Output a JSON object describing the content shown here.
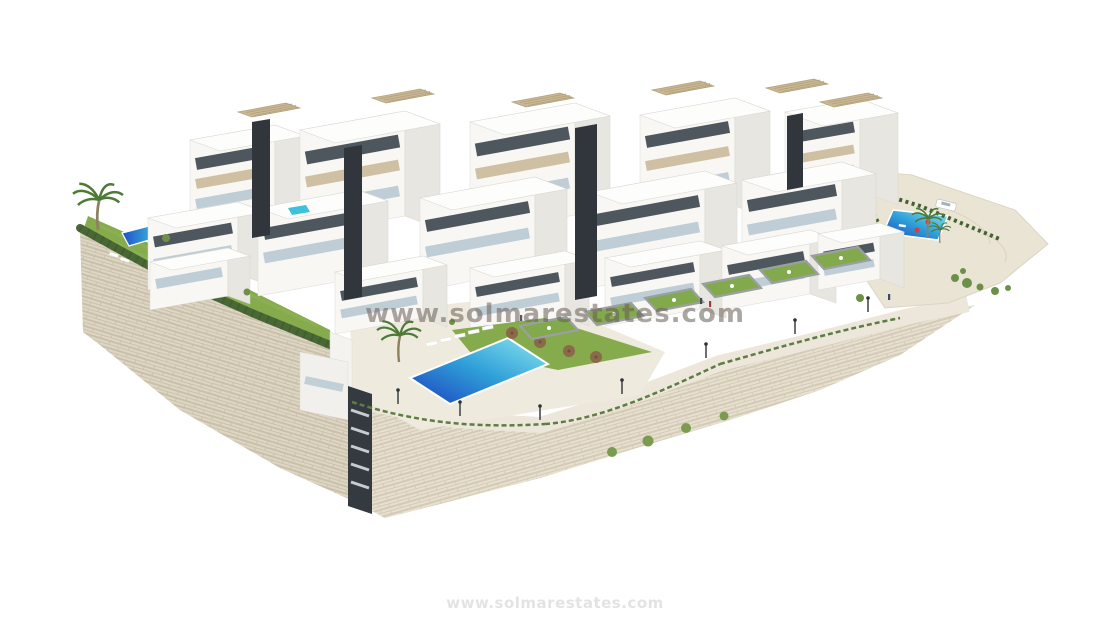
{
  "image": {
    "kind": "3d-architectural-render",
    "description": "Aerial 3D render of a modern white hillside residential complex with terraced apartment blocks, rooftop pergolas, private gardens, swimming pools, palm trees and a large stone retaining wall on a white background",
    "background_color": "#ffffff"
  },
  "watermark": {
    "center": "www.solmarestates.com",
    "bottom": "www.solmarestates.com"
  },
  "palette": {
    "stone_wall": "#e7e0d0",
    "stone_wall_shaded": "#ded6c4",
    "stone_joints": "#d0c6b0",
    "building_white": "#f8f7f4",
    "building_side": "#e7e6e1",
    "dark_accent": "#30363c",
    "window_dark": "#4e565e",
    "panel_beige": "#cfc0a3",
    "pergola_beige": "#cab894",
    "glass_balcony": "#b6c8d1",
    "lawn": "#85ab4d",
    "hedge": "#4a6836",
    "pool_deep": "#1c40bf",
    "pool_light": "#8ce6f0",
    "paving": "#ece7da"
  },
  "scene_elements": [
    "apartment-blocks",
    "penthouse-pergolas",
    "dark-accent-shafts",
    "stone-retaining-wall",
    "street-lamps",
    "communal-pool",
    "private-pools",
    "sun-loungers",
    "parasols",
    "lawns",
    "hedges",
    "palm-trees",
    "white-car",
    "pedestrians"
  ]
}
